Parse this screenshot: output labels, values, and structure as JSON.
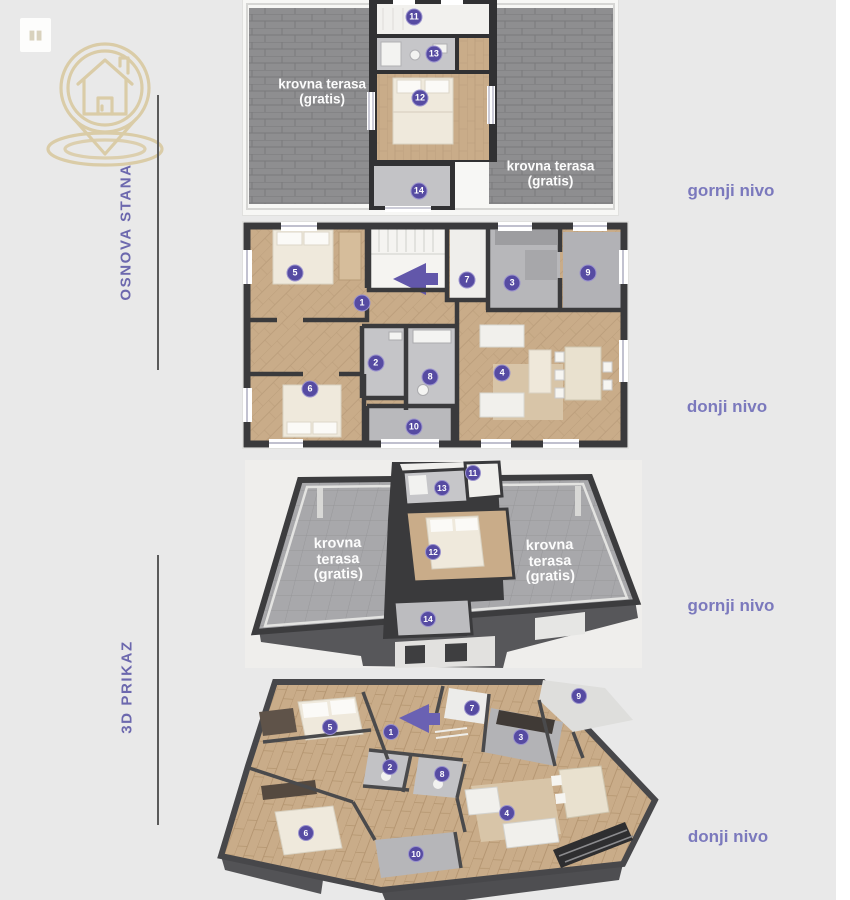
{
  "branding": {
    "logo_name": "house-location-pin-logo",
    "logo_color": "#d8c79c",
    "thumb_icon": "chart-bars-icon"
  },
  "sections": {
    "osnova": {
      "label": "OSNOVA STANA"
    },
    "prikaz": {
      "label": "3D PRIKAZ"
    }
  },
  "colors": {
    "accent_purple": "#564ba2",
    "label_purple": "#7b79bd",
    "section_purple": "#6c68ae",
    "logo_gold": "#d8c79c",
    "wall_dark": "#3a3a3c",
    "wood_floor": "#c9ac89",
    "tile_gray": "#c2c2c5",
    "terrace_gray": "#8e8e90",
    "page_background": "#e9e9e9"
  },
  "plans": {
    "plan2d_upper": {
      "title": "osnova stana - gornji nivo",
      "level_label": "gornji nivo",
      "terrace_labels": [
        {
          "lines": [
            "krovna terasa",
            "(gratis)"
          ],
          "x": 21.1,
          "y": 42.8
        },
        {
          "lines": [
            "krovna terasa",
            "(gratis)"
          ],
          "x": 82.0,
          "y": 80.9
        }
      ],
      "markers": [
        {
          "n": "11",
          "x": 45.6,
          "y": 7.9
        },
        {
          "n": "13",
          "x": 50.9,
          "y": 25.1
        },
        {
          "n": "12",
          "x": 47.2,
          "y": 45.6
        },
        {
          "n": "14",
          "x": 46.9,
          "y": 89.0
        }
      ]
    },
    "plan2d_lower": {
      "title": "osnova stana - donji nivo",
      "level_label": "donji nivo",
      "terrace_labels": [],
      "markers": [
        {
          "n": "5",
          "x": 13.5,
          "y": 22.6
        },
        {
          "n": "1",
          "x": 30.9,
          "y": 35.8
        },
        {
          "n": "7",
          "x": 58.2,
          "y": 25.7
        },
        {
          "n": "3",
          "x": 69.9,
          "y": 27.0
        },
        {
          "n": "9",
          "x": 89.6,
          "y": 22.6
        },
        {
          "n": "2",
          "x": 34.5,
          "y": 62.4
        },
        {
          "n": "8",
          "x": 48.6,
          "y": 68.6
        },
        {
          "n": "6",
          "x": 17.4,
          "y": 73.9
        },
        {
          "n": "4",
          "x": 67.3,
          "y": 66.8
        },
        {
          "n": "10",
          "x": 44.4,
          "y": 90.7
        }
      ]
    },
    "plan3d_upper": {
      "title": "3D prikaz - gornji nivo",
      "level_label": "gornji nivo",
      "terrace_labels": [
        {
          "lines": [
            "krovna",
            "terasa",
            "(gratis)"
          ],
          "x": 23.4,
          "y": 48.1
        },
        {
          "lines": [
            "krovna",
            "terasa",
            "(gratis)"
          ],
          "x": 76.8,
          "y": 49.0
        }
      ],
      "markers": [
        {
          "n": "11",
          "x": 57.4,
          "y": 6.3
        },
        {
          "n": "13",
          "x": 49.6,
          "y": 13.5
        },
        {
          "n": "12",
          "x": 47.4,
          "y": 44.2
        },
        {
          "n": "14",
          "x": 46.1,
          "y": 76.4
        }
      ]
    },
    "plan3d_lower": {
      "title": "3D prikaz - donji nivo",
      "level_label": "donji nivo",
      "terrace_labels": [],
      "markers": [
        {
          "n": "5",
          "x": 26.3,
          "y": 24.1
        },
        {
          "n": "1",
          "x": 38.9,
          "y": 26.3
        },
        {
          "n": "7",
          "x": 55.7,
          "y": 15.8
        },
        {
          "n": "9",
          "x": 77.8,
          "y": 10.5
        },
        {
          "n": "3",
          "x": 65.8,
          "y": 28.5
        },
        {
          "n": "2",
          "x": 38.7,
          "y": 41.7
        },
        {
          "n": "8",
          "x": 49.5,
          "y": 44.7
        },
        {
          "n": "4",
          "x": 62.9,
          "y": 61.8
        },
        {
          "n": "6",
          "x": 21.3,
          "y": 70.6
        },
        {
          "n": "10",
          "x": 44.1,
          "y": 79.8
        }
      ]
    }
  }
}
